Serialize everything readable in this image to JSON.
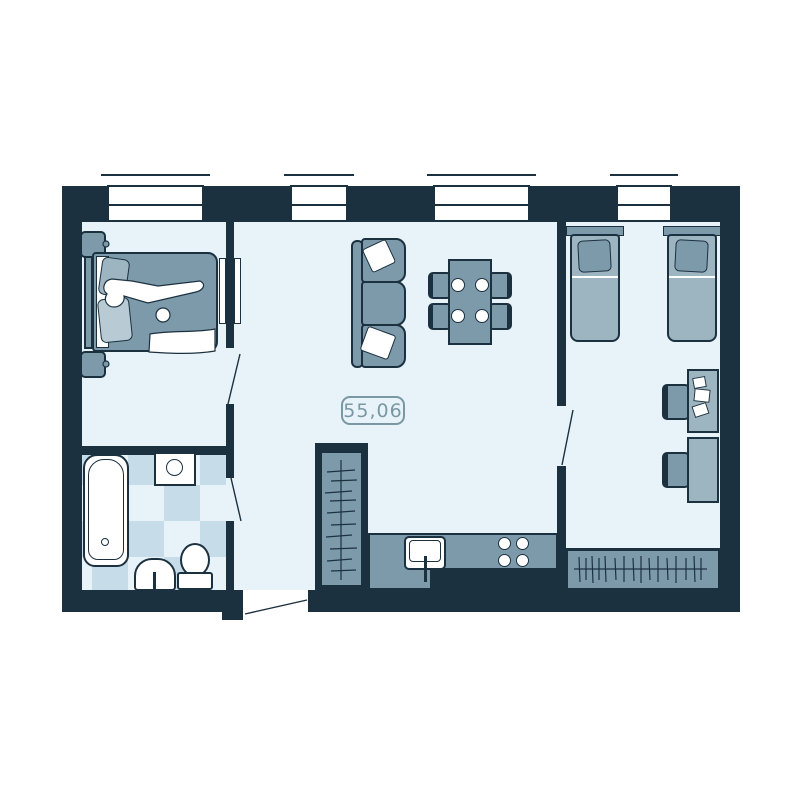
{
  "floorplan": {
    "area_label": "55,06",
    "colors": {
      "wall": "#1c3140",
      "floor": "#e7f3f8",
      "furn": "#7d9aab",
      "furn-light": "#9db4c1",
      "furn-lighter": "#b8cbd5",
      "tile": "#c6dde9",
      "fixture": "#ffffff",
      "label": "#7a97a4"
    }
  }
}
